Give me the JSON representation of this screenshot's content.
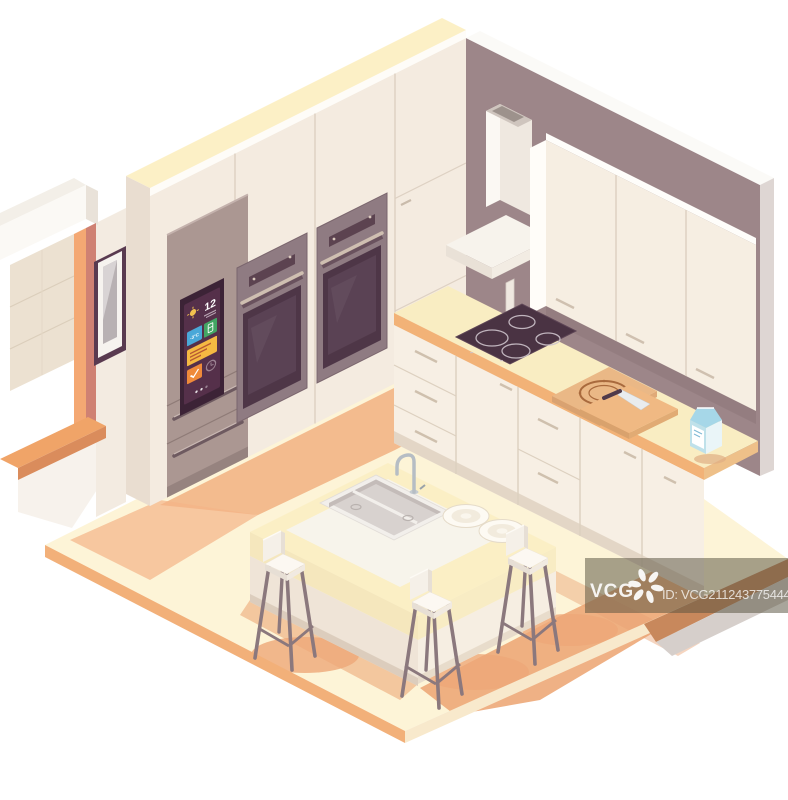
{
  "scene": {
    "title": "Isometric kitchen cross-section illustration",
    "canvas": {
      "width": 788,
      "height": 800
    }
  },
  "colors": {
    "background": "#ffffff",
    "floor": "#fdf4d7",
    "floor_edge": "#f2b079",
    "floor_shadow": "#eda878",
    "wall_right": "#9d8689",
    "cabinet_front": "#f4ebe0",
    "cabinet_top": "#fcf0c6",
    "upper_cabinet_front": "#f6eee2",
    "counter_top": "#f9edc2",
    "counter_edge": "#f2b277",
    "island_top": "#fbefc5",
    "island_side": "#efe4d7",
    "fridge_body": "#ab9792",
    "fridge_screen": "#55304a",
    "oven_glass": "#4e3647",
    "oven_frame": "#8f7b82",
    "cooktop": "#4a3343",
    "window_frame": "#f4a873",
    "window_trim": "#cf8173",
    "roller_blind": "#ece1d1",
    "picture_frame": "#593a50",
    "pizza_box": "#eab886",
    "pizza_print": "#a96a3d",
    "milk_carton": "#bfe1ea",
    "stool_leg": "#8b787d",
    "tile_blue": "#4aa8d8",
    "tile_green": "#43a564",
    "tile_amber": "#f5b942",
    "tile_orange": "#ef8a3a"
  },
  "fridge_display": {
    "time": "12",
    "freezer_temp": "-3°C",
    "icons": [
      "sun-icon",
      "fridge-icon",
      "check-icon",
      "clock-icon"
    ]
  },
  "watermark": {
    "brand": "VCG",
    "image_id": "ID: VCG211243775444",
    "logo": "pinwheel-logo"
  },
  "objects": [
    "smart-refrigerator",
    "wall-oven",
    "wall-oven",
    "range-hood",
    "induction-cooktop",
    "upper-cabinets",
    "tall-cabinets",
    "base-cabinets",
    "kitchen-island",
    "double-sink",
    "faucet",
    "plates",
    "bar-stool",
    "bar-stool",
    "bar-stool",
    "pizza-box",
    "milk-carton",
    "cutting-board",
    "knife",
    "window",
    "roller-blind",
    "picture-frame"
  ]
}
